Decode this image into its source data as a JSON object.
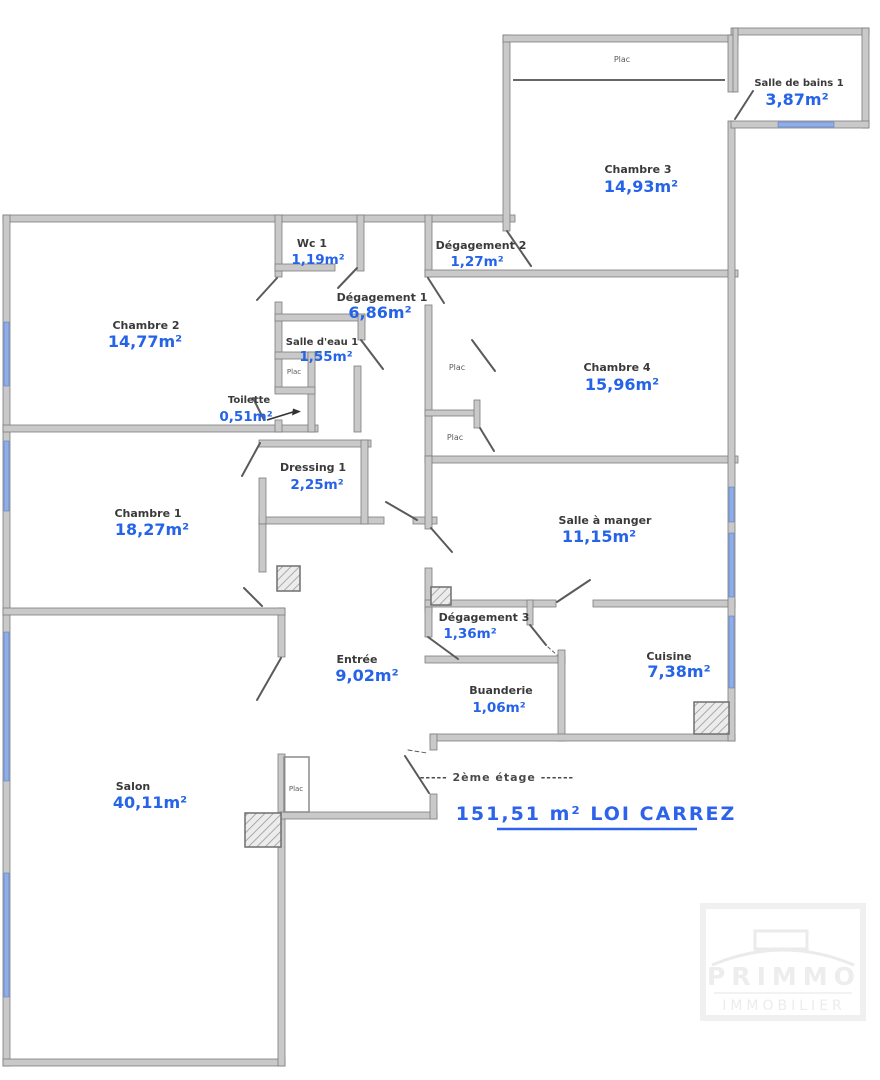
{
  "plan": {
    "floor_note": "----- 2ème étage ------",
    "total_area": "151,51 m²  LOI CARREZ",
    "closet_label": "Plac",
    "rooms": [
      {
        "name": "Chambre 3",
        "area": "14,93m²"
      },
      {
        "name": "Salle de bains 1",
        "area": "3,87m²"
      },
      {
        "name": "Wc 1",
        "area": "1,19m²"
      },
      {
        "name": "Dégagement 2",
        "area": "1,27m²"
      },
      {
        "name": "Chambre 2",
        "area": "14,77m²"
      },
      {
        "name": "Dégagement 1",
        "area": "6,86m²"
      },
      {
        "name": "Salle d'eau 1",
        "area": "1,55m²"
      },
      {
        "name": "Toilette",
        "area": "0,51m²"
      },
      {
        "name": "Chambre 4",
        "area": "15,96m²"
      },
      {
        "name": "Chambre 1",
        "area": "18,27m²"
      },
      {
        "name": "Dressing 1",
        "area": "2,25m²"
      },
      {
        "name": "Salle à manger",
        "area": "11,15m²"
      },
      {
        "name": "Dégagement 3",
        "area": "1,36m²"
      },
      {
        "name": "Entrée",
        "area": "9,02m²"
      },
      {
        "name": "Buanderie",
        "area": "1,06m²"
      },
      {
        "name": "Cuisine",
        "area": "7,38m²"
      },
      {
        "name": "Salon",
        "area": "40,11m²"
      }
    ],
    "watermark": {
      "line1": "PRIMMO",
      "line2": "IMMOBILIER"
    },
    "colors": {
      "area_value": "#2563e8",
      "wall": "#c9c9c9",
      "window": "#8fadea"
    }
  }
}
